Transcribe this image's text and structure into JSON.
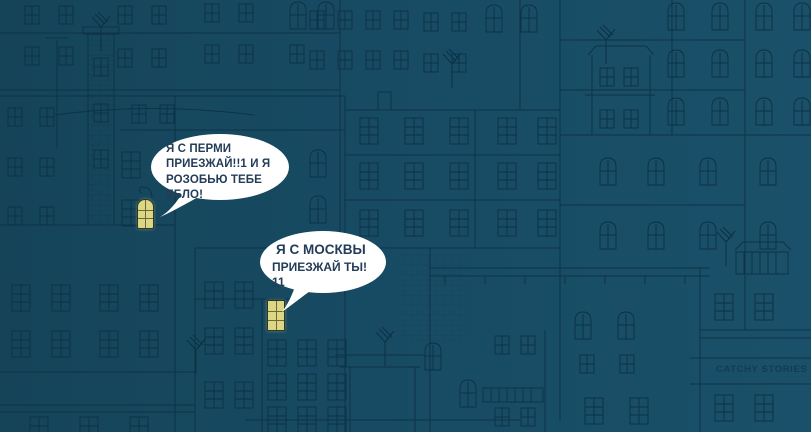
{
  "bubble_perm": {
    "lines": [
      "Я С ПЕРМИ",
      "ПРИЕЗЖАЙ!!1 И Я",
      "РОЗОБЬЮ ТЕБЕ",
      "ЕБЛО!"
    ]
  },
  "bubble_moscow": {
    "lines": [
      "Я С МОСКВЫ",
      "ПРИЕЗЖАЙ ТЫ!",
      "11"
    ]
  },
  "watermark": "CATCHY STORIES",
  "colors": {
    "background_left": "#154459",
    "background_mid": "#174b63",
    "background_right": "#1a5069",
    "line_art": "#0c3145",
    "bubble_fill": "#ffffff",
    "bubble_text": "#233c58",
    "lit_window_fill": "#dcd784",
    "lit_window_mullion": "#6e6838",
    "watermark_text": "#113c54"
  }
}
